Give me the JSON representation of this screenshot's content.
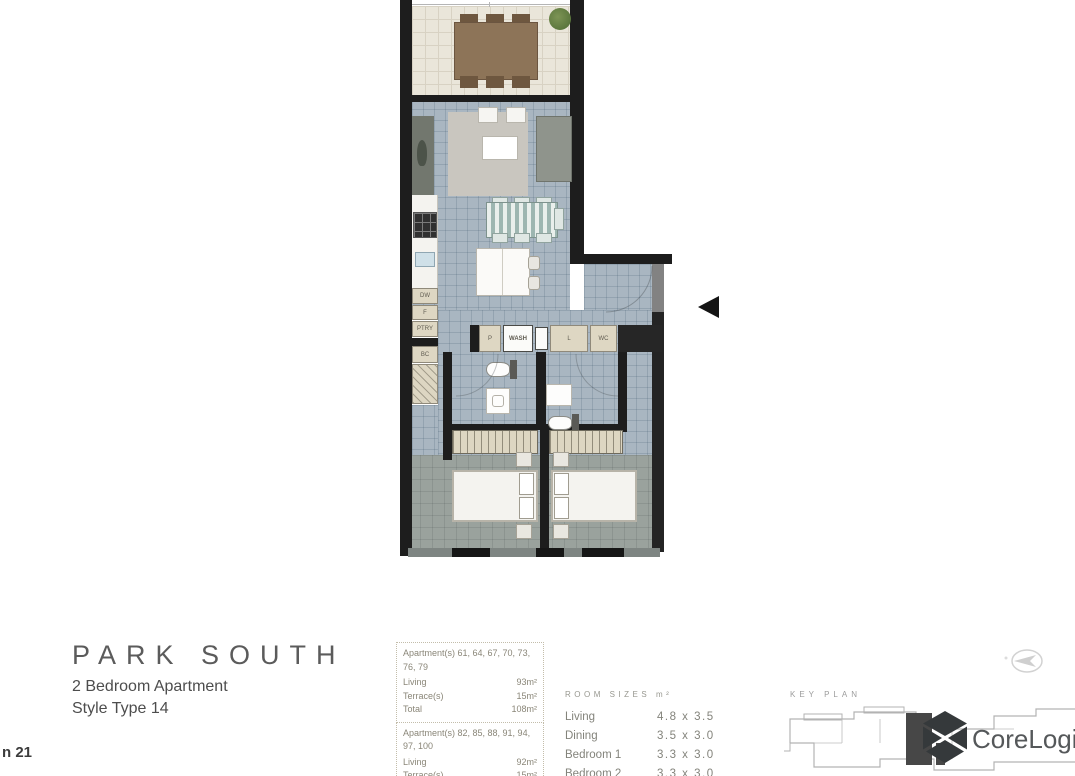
{
  "title": {
    "name": "PARK SOUTH",
    "subtitle": "2 Bedroom Apartment",
    "style_type": "Style Type 14"
  },
  "corner_text": "n 21",
  "info_blocks": [
    {
      "apartments": "Apartment(s) 61, 64, 67, 70, 73, 76, 79",
      "rows": [
        {
          "label": "Living",
          "value": "93m²"
        },
        {
          "label": "Terrace(s)",
          "value": "15m²"
        },
        {
          "label": "Total",
          "value": "108m²"
        }
      ]
    },
    {
      "apartments": "Apartment(s) 82, 85, 88, 91, 94, 97, 100",
      "rows": [
        {
          "label": "Living",
          "value": "92m²"
        },
        {
          "label": "Terrace(s)",
          "value": "15m²"
        },
        {
          "label": "Total",
          "value": "107m²"
        }
      ]
    }
  ],
  "room_sizes": {
    "heading": "ROOM SIZES m²",
    "rows": [
      {
        "label": "Living",
        "value": "4.8 x 3.5"
      },
      {
        "label": "Dining",
        "value": "3.5 x 3.0"
      },
      {
        "label": "Bedroom 1",
        "value": "3.3 x 3.0"
      },
      {
        "label": "Bedroom 2",
        "value": "3.3 x 3.0"
      }
    ]
  },
  "key_plan": {
    "heading": "KEY PLAN"
  },
  "brand": {
    "name": "CoreLogic"
  },
  "plan": {
    "labels": {
      "dw": "DW",
      "fridge": "F",
      "ptry": "PTRY",
      "bc": "BC",
      "pantry": "P",
      "wash": "WASH",
      "linen": "L",
      "wc": "WC"
    }
  },
  "colors": {
    "wall": "#1d1d1d",
    "terrace_floor": "#eae6da",
    "living_floor": "#a9b6c1",
    "bedroom_floor": "#9aa29d",
    "cabinet": "#ded7c3",
    "brand_mark": "#35393b"
  }
}
